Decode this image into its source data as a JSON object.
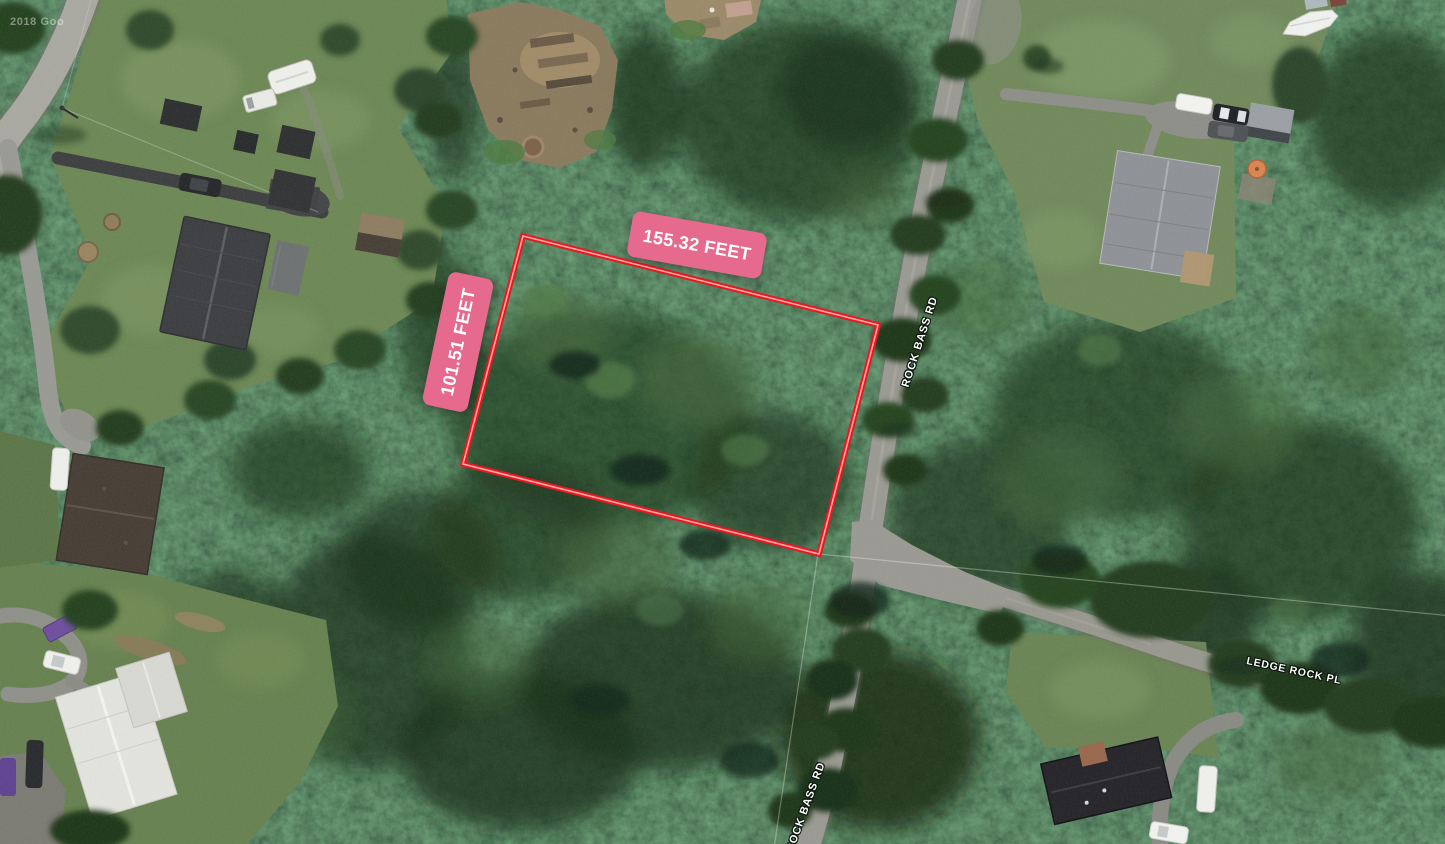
{
  "map": {
    "type": "satellite-imagery",
    "watermark": "2018 Goo",
    "imagery_colors": {
      "forest": "#233f1e",
      "lawn": "#6c8754",
      "road": "#9a9a93",
      "dirt": "#8b7a5d"
    }
  },
  "parcel": {
    "width_label": "155.32 FEET",
    "height_label": "101.51 FEET",
    "outline_color": "#e81822",
    "outline_core_color": "#ffaaa2",
    "badge_color": "#e56a8e",
    "badge_text_color": "#ffffff",
    "points_attr": "523,236 878,325 819,554 463,464"
  },
  "roads": {
    "rock_bass": {
      "label": "ROCK BASS RD"
    },
    "ledge_rock": {
      "label": "LEDGE ROCK PL"
    }
  }
}
